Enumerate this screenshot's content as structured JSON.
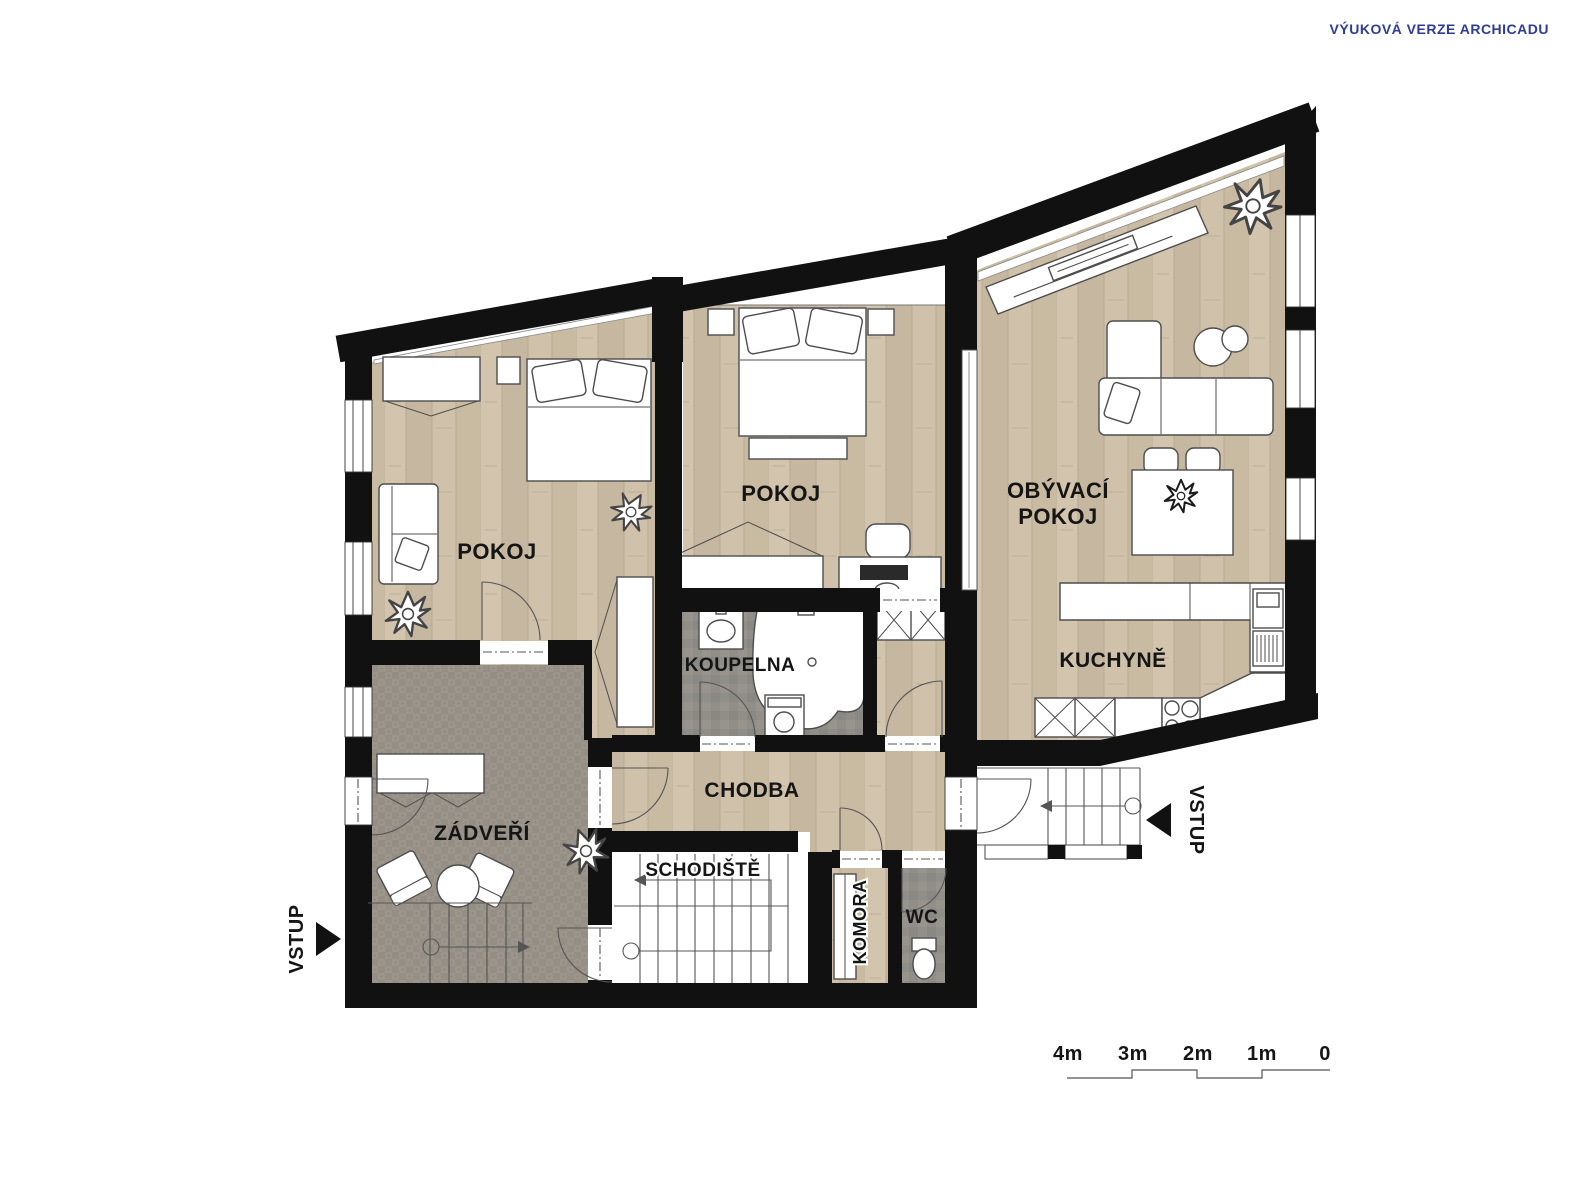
{
  "watermark": {
    "text": "VÝUKOVÁ VERZE ARCHICADU",
    "color": "#2f3c96"
  },
  "rooms": {
    "pokoj_left": {
      "label": "POKOJ"
    },
    "pokoj_middle": {
      "label": "POKOJ"
    },
    "obyvaci_pokoj": {
      "label_line1": "OBÝVACÍ",
      "label_line2": "POKOJ"
    },
    "kuchyne": {
      "label": "KUCHYNĚ"
    },
    "koupelna": {
      "label": "KOUPELNA"
    },
    "chodba": {
      "label": "CHODBA"
    },
    "zadveri": {
      "label": "ZÁDVEŘÍ"
    },
    "schodiste": {
      "label": "SCHODIŠTĚ"
    },
    "komora": {
      "label": "KOMORA"
    },
    "wc": {
      "label": "WC"
    }
  },
  "entrances": {
    "left_label": "VSTUP",
    "right_label": "VSTUP"
  },
  "scale_bar": {
    "labels": [
      "4m",
      "3m",
      "2m",
      "1m",
      "0"
    ]
  },
  "colors": {
    "wall": "#111111",
    "wood_floor": "#cdbfa8",
    "carpet_floor": "#9a948b",
    "tile_floor": "#8f8d88",
    "furniture_outline": "#4d4d4d",
    "watermark": "#2f3c96"
  }
}
